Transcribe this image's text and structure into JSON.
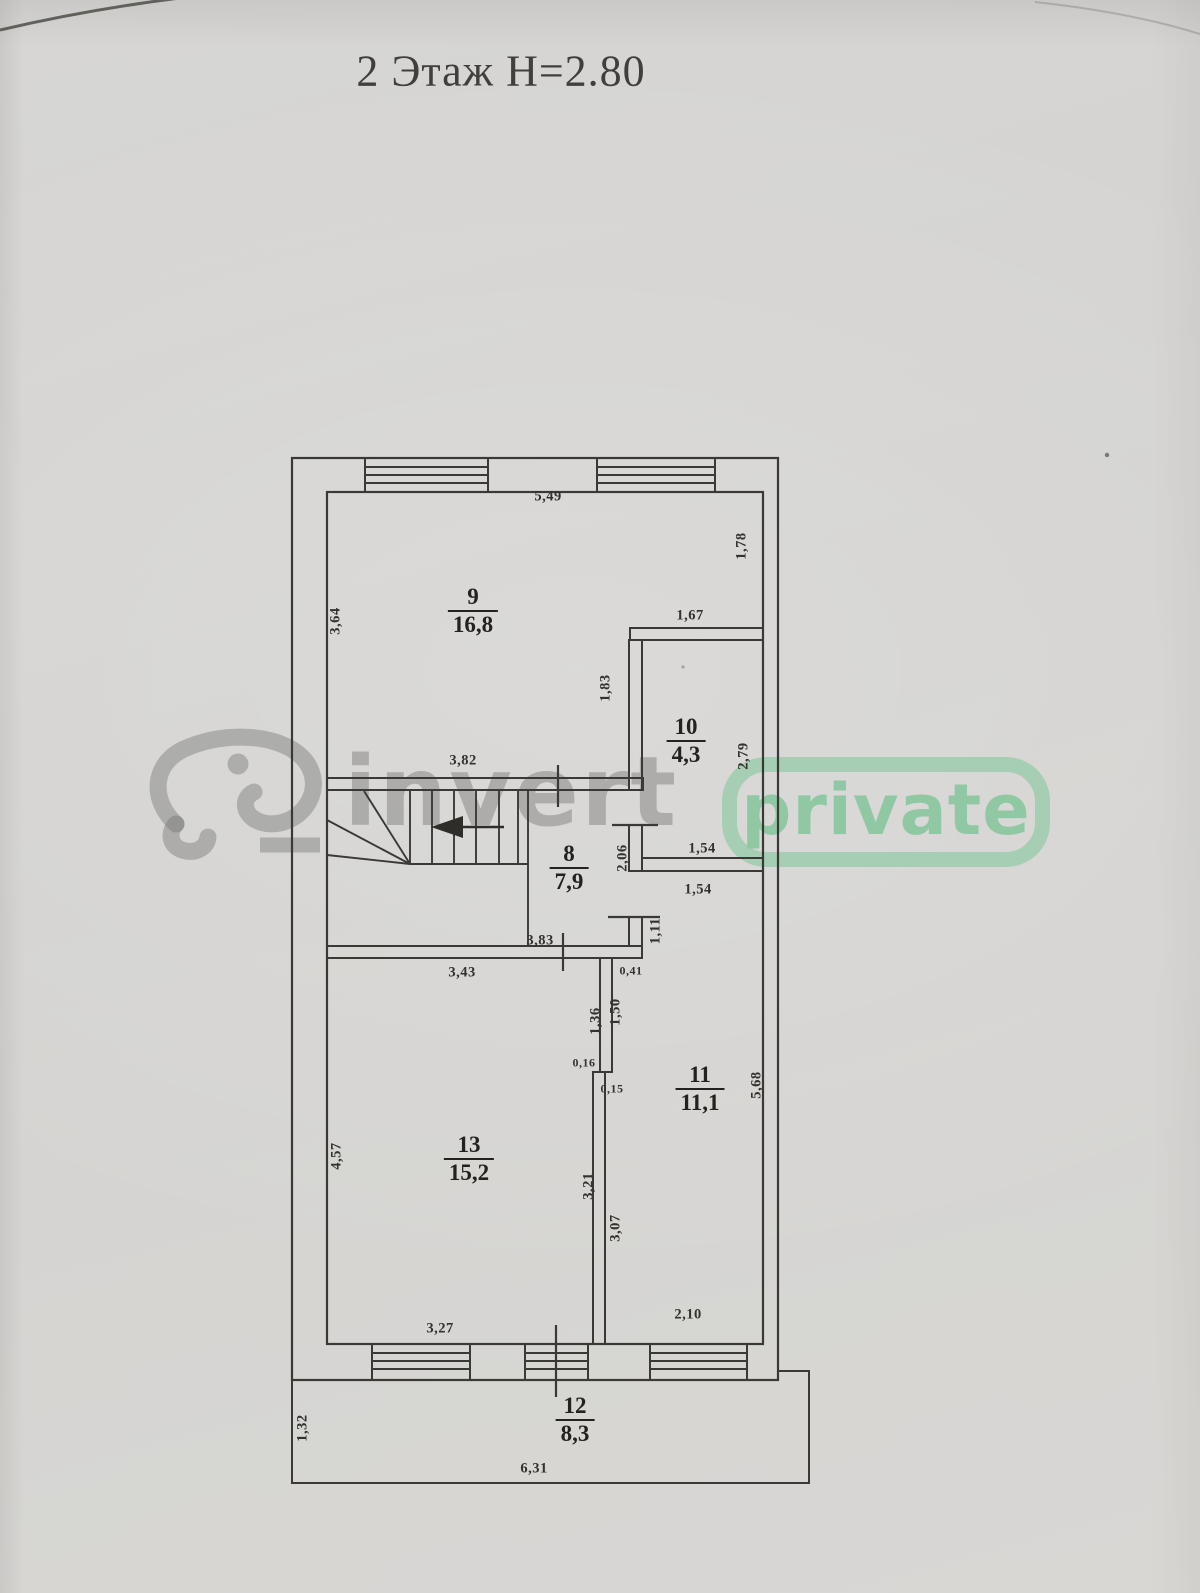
{
  "title": "2 Этаж Н=2.80",
  "watermark": {
    "brand": "invert",
    "badge": "private",
    "brand_color": "#70706e",
    "accent_color": "#8ac79f"
  },
  "colors": {
    "paper": "#d6d5d3",
    "line": "#3a3936",
    "text": "#33322e"
  },
  "rooms": [
    {
      "number": "9",
      "area": "16,8"
    },
    {
      "number": "10",
      "area": "4,3"
    },
    {
      "number": "8",
      "area": "7,9"
    },
    {
      "number": "11",
      "area": "11,1"
    },
    {
      "number": "13",
      "area": "15,2"
    },
    {
      "number": "12",
      "area": "8,3"
    }
  ],
  "dims": [
    "5,49",
    "1,78",
    "3,64",
    "1,67",
    "1,83",
    "2,79",
    "3,82",
    "2,06",
    "1,54",
    "1,54",
    "1,11",
    "3,83",
    "0,41",
    "3,43",
    "1,36",
    "1,50",
    "0,16",
    "0,15",
    "4,57",
    "5,68",
    "3,21",
    "3,07",
    "3,27",
    "2,10",
    "1,32",
    "6,31"
  ]
}
